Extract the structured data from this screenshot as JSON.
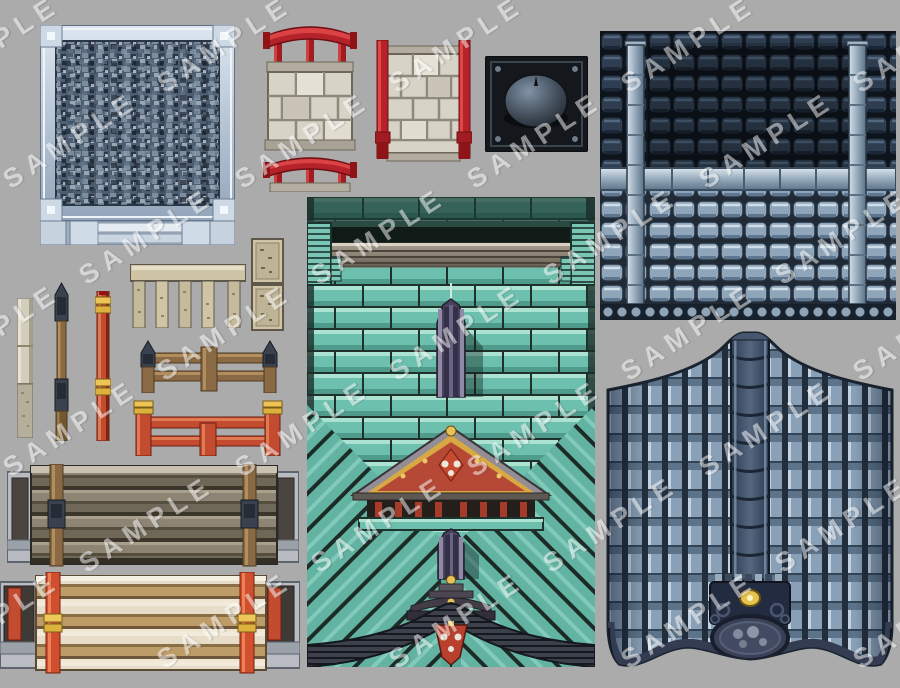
{
  "page": {
    "title": "RPG tileset sample sheet (oriental temple exterior tiles)",
    "background_color": "#ababab"
  },
  "watermark": {
    "text": "SAMPLE",
    "color": "#ffffff",
    "opacity": 0.5,
    "rotation_deg": -33
  },
  "assets": [
    {
      "id": "gravel-wall-panel",
      "label": "framed gravel/stone texture panel",
      "colors": [
        "#b6c4d4",
        "#4e5d6f",
        "#e8eff5"
      ]
    },
    {
      "id": "torii-rail-wall",
      "label": "stone wall with red torii rails top and bottom",
      "colors": [
        "#b5222a",
        "#d7d3c6"
      ]
    },
    {
      "id": "pole-wall",
      "label": "stone block wall with red side poles",
      "colors": [
        "#b5222a",
        "#d7d3c6"
      ]
    },
    {
      "id": "metal-dome-plate",
      "label": "dark metal plate with dome finial and rivets",
      "colors": [
        "#14171b",
        "#5a6878"
      ]
    },
    {
      "id": "roof-tile-sheet",
      "label": "roof tile autotile sheet, dark and light halves with ridge pipes",
      "colors": [
        "#2e3d50",
        "#8fa5ba",
        "#97abbd"
      ]
    },
    {
      "id": "teal-brick-tower",
      "label": "teal brick wall tower with beam, gable, purple ridges and arched eave",
      "colors": [
        "#6ec0ae",
        "#49425c",
        "#b64836",
        "#d8a843"
      ]
    },
    {
      "id": "curved-roof-slope",
      "label": "curved roof slope with center ridge, crest and medallion",
      "colors": [
        "#8aa0b6",
        "#232b40",
        "#e6c24e"
      ]
    },
    {
      "id": "stone-post",
      "label": "pale stone post",
      "colors": [
        "#d3cdbc"
      ]
    },
    {
      "id": "wood-post",
      "label": "wooden post with dark caps",
      "colors": [
        "#8a6a44",
        "#39424e"
      ]
    },
    {
      "id": "red-post",
      "label": "red post with gold rings",
      "colors": [
        "#c24b30",
        "#ecc556"
      ]
    },
    {
      "id": "stone-balustrade",
      "label": "stone balustrade fence segment",
      "colors": [
        "#cfc5a6"
      ]
    },
    {
      "id": "stone-pillar",
      "label": "stacked stone pillar blocks",
      "colors": [
        "#cfc5a6"
      ]
    },
    {
      "id": "wood-fence",
      "label": "wooden fence with capped posts",
      "colors": [
        "#8a6a44",
        "#39424e"
      ]
    },
    {
      "id": "red-fence",
      "label": "red fence with gold-capped posts",
      "colors": [
        "#c24b30",
        "#ecc556"
      ]
    },
    {
      "id": "bridge-dark",
      "label": "dark plank bridge with wooden posts and stone abutments",
      "colors": [
        "#8d8474",
        "#3c362a"
      ]
    },
    {
      "id": "bridge-light",
      "label": "light plank bridge with red posts and abutments",
      "colors": [
        "#e6dcc8",
        "#cf4f2e",
        "#eec75a"
      ]
    }
  ]
}
